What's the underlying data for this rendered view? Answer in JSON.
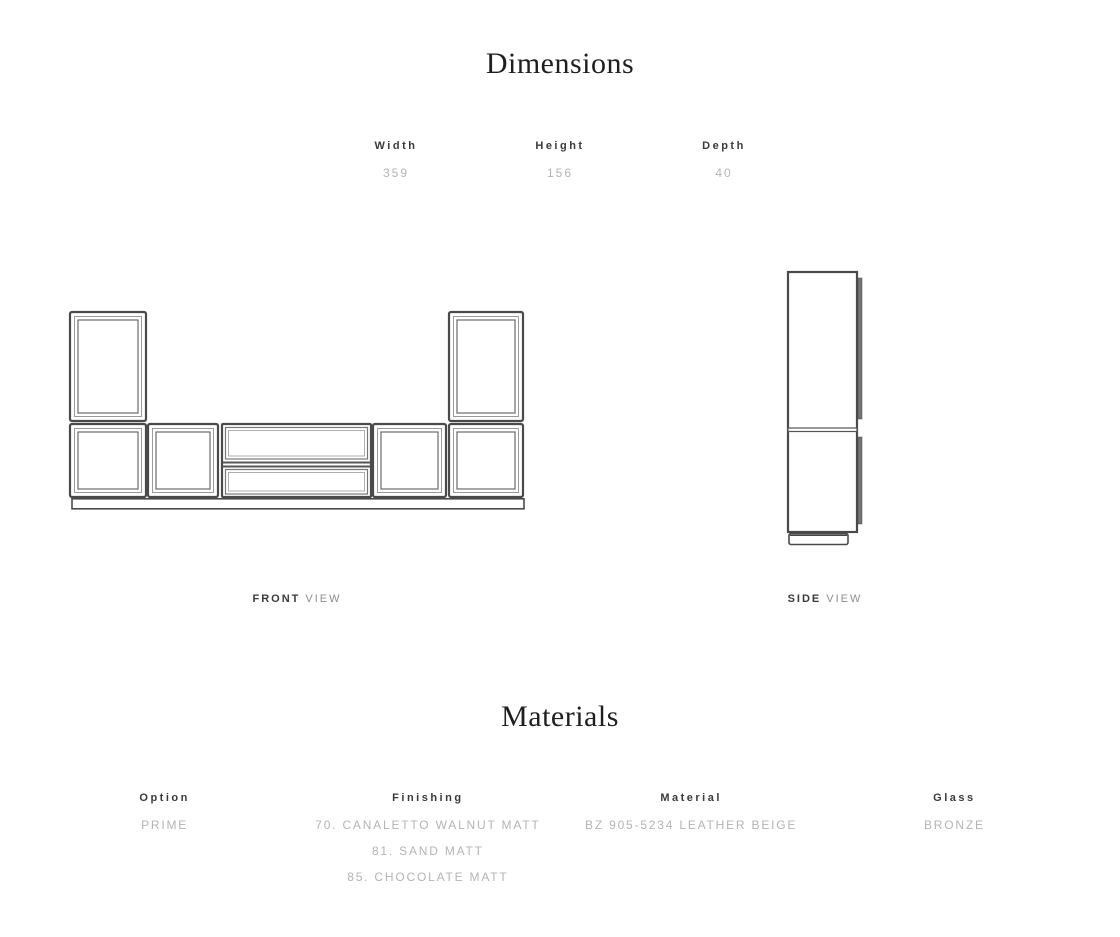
{
  "dimensions": {
    "title": "Dimensions",
    "columns": [
      {
        "label": "Width",
        "value": "359"
      },
      {
        "label": "Height",
        "value": "156"
      },
      {
        "label": "Depth",
        "value": "40"
      }
    ],
    "front_view_label": {
      "primary": "FRONT",
      "secondary": "VIEW"
    },
    "side_view_label": {
      "primary": "SIDE",
      "secondary": "VIEW"
    }
  },
  "materials": {
    "title": "Materials",
    "columns": [
      {
        "label": "Option",
        "values": [
          "PRIME"
        ]
      },
      {
        "label": "Finishing",
        "values": [
          "70. CANALETTO WALNUT MATT",
          "81. SAND MATT",
          "85. CHOCOLATE MATT"
        ]
      },
      {
        "label": "Material",
        "values": [
          "BZ 905-5234 LEATHER BEIGE"
        ]
      },
      {
        "label": "Glass",
        "values": [
          "BRONZE"
        ]
      }
    ]
  },
  "colors": {
    "heading": "#1f1f1f",
    "label": "#3a3a3a",
    "value_muted": "#b4b4b4",
    "view_word_muted": "#8f8f8f",
    "drawing_line": "#4a4a4a"
  }
}
